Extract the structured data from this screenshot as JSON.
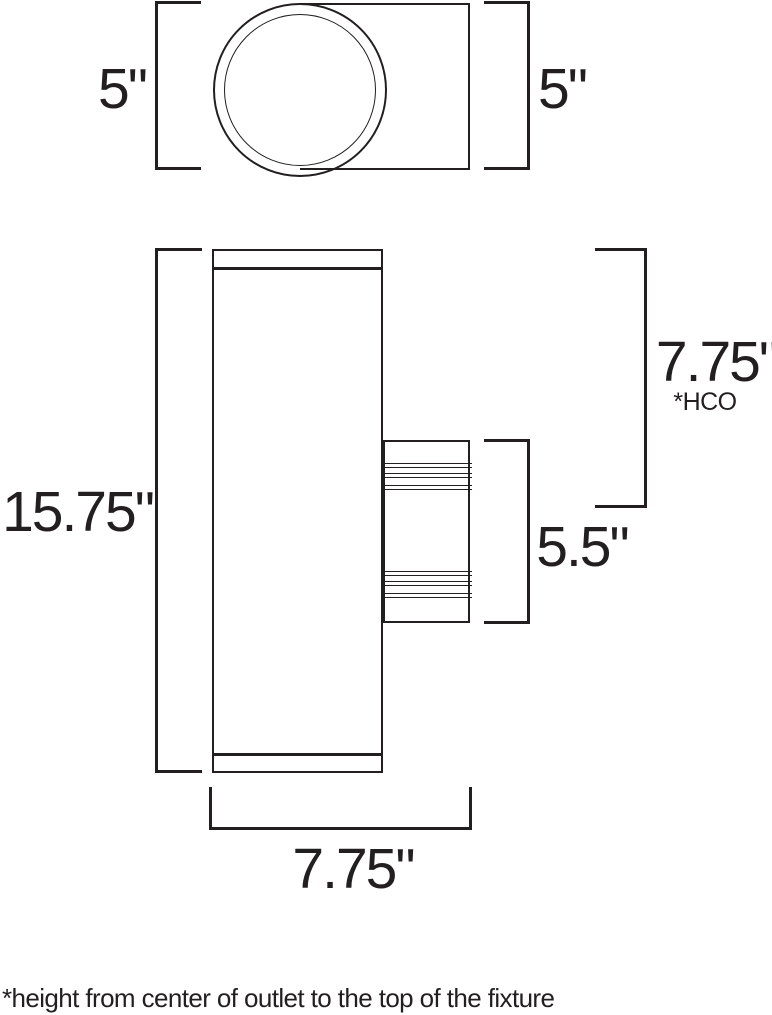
{
  "colors": {
    "ink": "#231f20",
    "background": "#ffffff"
  },
  "top_view": {
    "left_dim": "5\"",
    "right_dim": "5\""
  },
  "front_view": {
    "height_dim": "15.75\"",
    "hco_dim": "7.75\"",
    "hco_note": "*HCO",
    "outlet_box_dim": "5.5\"",
    "depth_dim": "7.75\""
  },
  "footnote": "*height from center of outlet to the top of the fixture"
}
